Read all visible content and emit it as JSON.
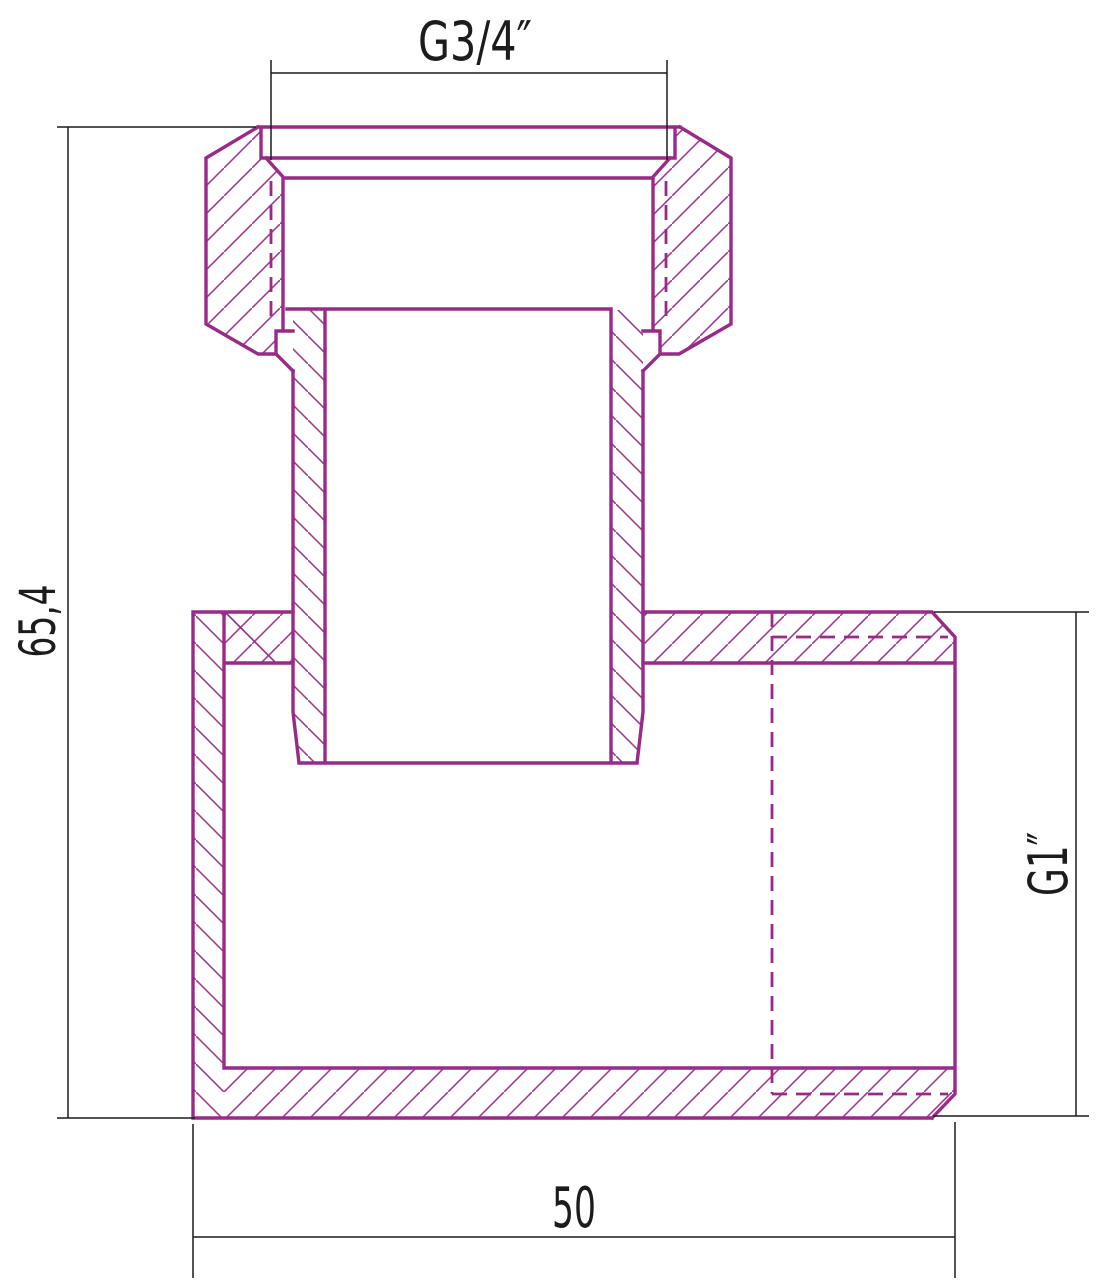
{
  "page": {
    "background": "#ffffff"
  },
  "drawing": {
    "kind": "technical-section-drawing-pipe-fitting",
    "labels": {
      "top_thread": "G3/4″",
      "overall_height": "65,4",
      "side_thread": "G1″",
      "overall_width": "50"
    },
    "colors": {
      "part_outline": "#992a88",
      "hatch": "#a13b92",
      "dimension": "#1c1c1c"
    }
  }
}
